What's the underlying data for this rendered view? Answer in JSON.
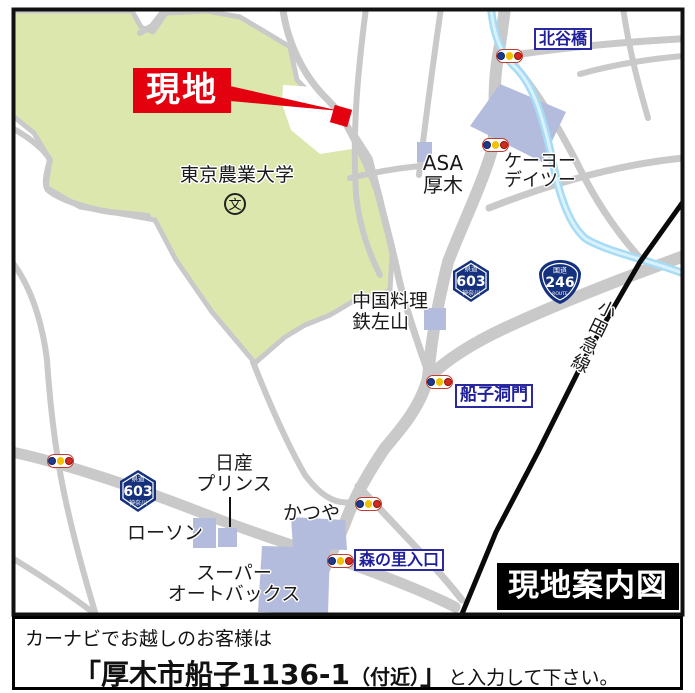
{
  "map": {
    "site_callout": "現地",
    "legend_title": "現地案内図",
    "landmarks": {
      "university": "東京農業大学",
      "school_symbol": "文",
      "asa_line1": "ASA",
      "asa_line2": "厚木",
      "keiyo_line1": "ケーヨー",
      "keiyo_line2": "デイツー",
      "china_line1": "中国料理",
      "china_line2": "鉄左山",
      "nissan_line1": "日産",
      "nissan_line2": "プリンス",
      "lawson": "ローソン",
      "katsuya": "かつや",
      "autobacs_line1": "スーパー",
      "autobacs_line2": "オートバックス",
      "odakyu_line": "小田急線"
    },
    "intersections": {
      "kitayabashi": "北谷橋",
      "funako_domon": "船子洞門",
      "morinosato": "森の里入口"
    },
    "route_shields": {
      "pref603": {
        "kind": "県道",
        "number": "603",
        "region": "神奈川"
      },
      "national246": {
        "kind": "国道",
        "number": "246",
        "bottom": "ROUTE"
      }
    },
    "colors": {
      "campus_green": "#dce7ae",
      "road_gray": "#c9c9c9",
      "building_purple": "#b3bcdc",
      "river_blue": "#a8dcf5",
      "railway_black": "#0a0a0a",
      "site_red": "#e3000f",
      "label_blue": "#1f1f9c",
      "signal_blue": "#1e3a8f",
      "signal_yellow": "#f3c100",
      "signal_red": "#d42a1e"
    }
  },
  "footer": {
    "line1": "カーナビでお越しのお客様は",
    "address_open": "「厚木市船子1136-1",
    "address_paren": "（付近）",
    "address_close": "」",
    "suffix": "と入力して下さい。"
  }
}
